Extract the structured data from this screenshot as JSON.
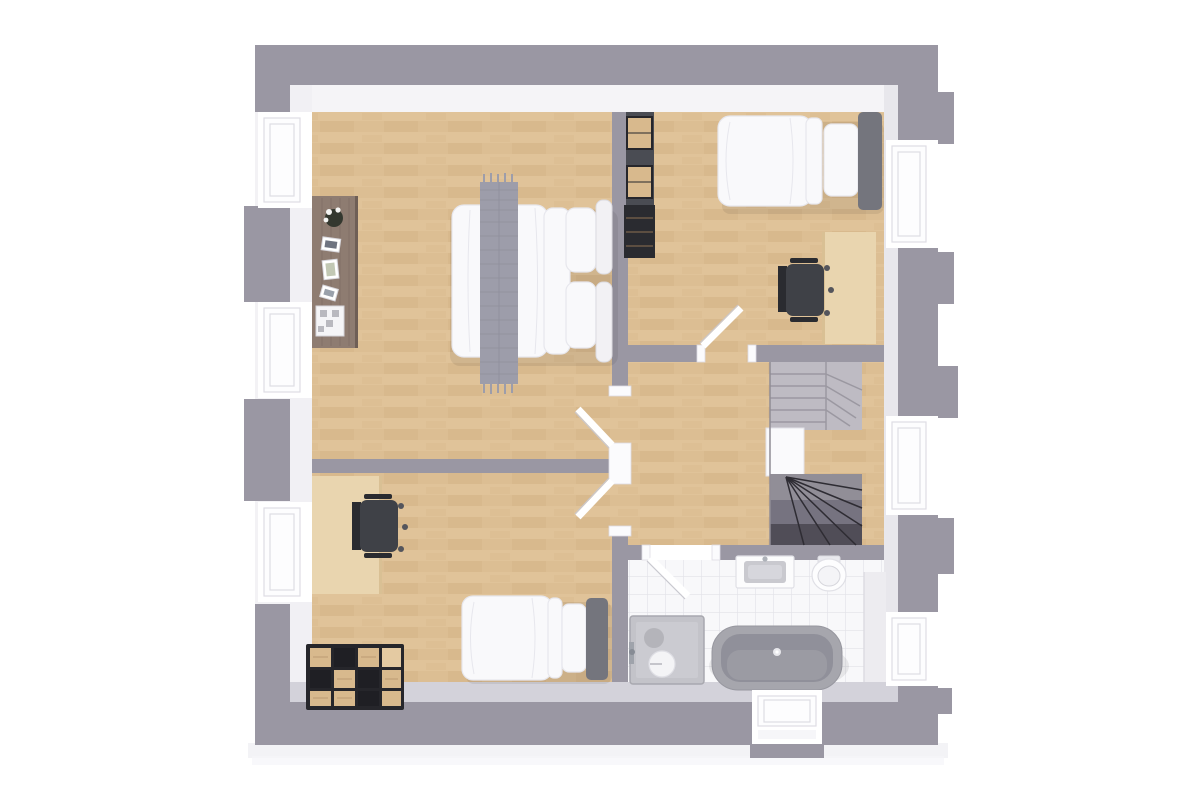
{
  "scene": {
    "description": "3D top-down architectural floor-plan render of an upper storey with three bedrooms, a bathroom, a landing and a U-shaped winder staircase",
    "view": "top-down",
    "rooms": [
      {
        "id": "master-bedroom",
        "position": "top-left",
        "floor": "wood",
        "furniture": [
          "double-bed",
          "gray-knit-throw",
          "pillows",
          "white-headboard",
          "sideboard",
          "plant",
          "picture-frames",
          "storage-box"
        ]
      },
      {
        "id": "bedroom-2",
        "position": "top-right",
        "floor": "wood",
        "furniture": [
          "single-bed",
          "desk",
          "office-chair",
          "shelf-unit-with-crates"
        ]
      },
      {
        "id": "bedroom-3",
        "position": "bottom-left",
        "floor": "wood",
        "furniture": [
          "single-bed",
          "desk",
          "office-chair",
          "cube-crate-storage"
        ]
      },
      {
        "id": "bathroom",
        "position": "bottom-right",
        "floor": "white-tile",
        "furniture": [
          "freestanding-bathtub",
          "shower-tray",
          "round-stool",
          "vanity-sink",
          "toilet"
        ]
      },
      {
        "id": "landing",
        "position": "center-right",
        "floor": "wood",
        "furniture": []
      },
      {
        "id": "staircase",
        "position": "right",
        "type": "u-shaped-winder",
        "flights": [
          "upper-light",
          "lower-dark"
        ]
      }
    ],
    "doors": [
      {
        "id": "master-bedroom-door",
        "state": "open"
      },
      {
        "id": "bedroom-2-door",
        "state": "open"
      },
      {
        "id": "bedroom-3-door",
        "state": "open"
      },
      {
        "id": "bathroom-door",
        "state": "open"
      }
    ],
    "windows": [
      {
        "wall": "left",
        "count": 3
      },
      {
        "wall": "right",
        "count": 3
      },
      {
        "wall": "bottom",
        "count": 1
      }
    ]
  },
  "palette": {
    "bg": "#ffffff",
    "wall": "#9a97a3",
    "face_top": "#f5f4f7",
    "face_left": "#f1f0f4",
    "face_right": "#e8e7ec",
    "face_bottom": "#d3d2da",
    "wood": "#dcbe93",
    "wood_light": "#e4caa0",
    "wood_dark": "#cfae80",
    "tile": "#f8f8fa",
    "tile_line": "#e2e2e8",
    "glass": "#fdfdfe",
    "frame_line": "#dedde4",
    "jamb": "#fbfbfd",
    "duvet": "#f9f9fb",
    "duvet_line": "#e7e7ed",
    "throw": "#9d9daa",
    "throw_line": "#8b8b99",
    "headboard_dark": "#74757d",
    "headboard_white": "#f2f1f4",
    "desk": "#e9d5af",
    "desk_edge": "#d9c094",
    "chair": "#3f4147",
    "chair_dark": "#2a2b30",
    "stair_up": "#bebbc3",
    "stair_up_line": "#9b98a1",
    "stair_mid1": "#918e97",
    "stair_mid2": "#767380",
    "stair_low": "#504d57",
    "stair_line": "#2e2c33",
    "tub": "#a6a6ad",
    "tub_inner": "#90909a",
    "tub_floor": "#9c9ca4",
    "shower": "#c3c3c9",
    "shower_inner": "#cbcbd1",
    "shower_drain": "#b0b0b6",
    "sideboard": "#8e7c71",
    "sideboard_line": "#7a685e",
    "crate": "#d8b98d",
    "crate_light": "#e4caa2",
    "crate_frame": "#26262b",
    "shelf": "#4a4c53"
  }
}
